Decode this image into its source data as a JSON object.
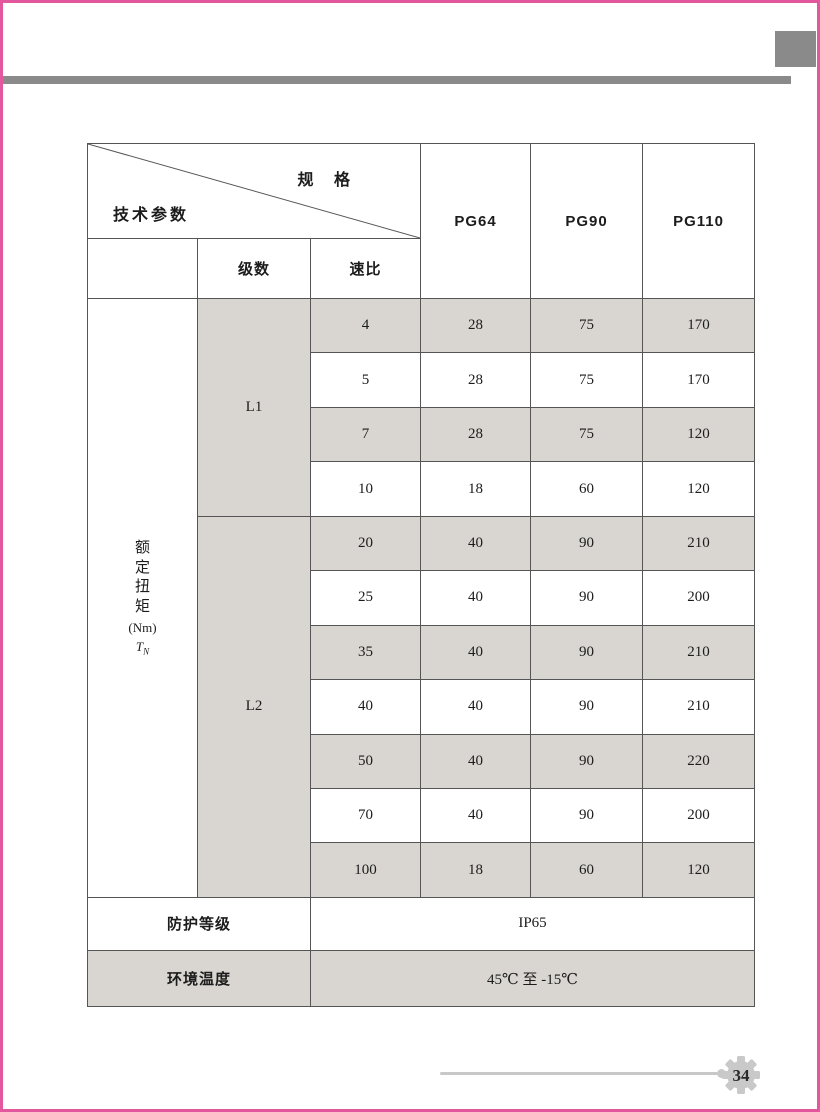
{
  "page": {
    "page_number": "34",
    "accent_pink": "#e2579e",
    "bar_gray": "#8a8a8a",
    "shade_gray": "#d9d6d1"
  },
  "table": {
    "corner": {
      "top_label": "规 格",
      "bottom_label": "技术参数"
    },
    "spec_columns": [
      "PG64",
      "PG90",
      "PG110"
    ],
    "subheaders": {
      "stages": "级数",
      "ratio": "速比"
    },
    "torque": {
      "vertical_label": "额定扭矩",
      "unit": "(Nm)",
      "symbol": "T",
      "symbol_sub": "N"
    },
    "groups": {
      "l1": "L1",
      "l2": "L2"
    },
    "rows": [
      {
        "ratio": "4",
        "pg64": "28",
        "pg90": "75",
        "pg110": "170"
      },
      {
        "ratio": "5",
        "pg64": "28",
        "pg90": "75",
        "pg110": "170"
      },
      {
        "ratio": "7",
        "pg64": "28",
        "pg90": "75",
        "pg110": "120"
      },
      {
        "ratio": "10",
        "pg64": "18",
        "pg90": "60",
        "pg110": "120"
      },
      {
        "ratio": "20",
        "pg64": "40",
        "pg90": "90",
        "pg110": "210"
      },
      {
        "ratio": "25",
        "pg64": "40",
        "pg90": "90",
        "pg110": "200"
      },
      {
        "ratio": "35",
        "pg64": "40",
        "pg90": "90",
        "pg110": "210"
      },
      {
        "ratio": "40",
        "pg64": "40",
        "pg90": "90",
        "pg110": "210"
      },
      {
        "ratio": "50",
        "pg64": "40",
        "pg90": "90",
        "pg110": "220"
      },
      {
        "ratio": "70",
        "pg64": "40",
        "pg90": "90",
        "pg110": "200"
      },
      {
        "ratio": "100",
        "pg64": "18",
        "pg90": "60",
        "pg110": "120"
      }
    ],
    "footer_rows": [
      {
        "label": "防护等级",
        "value": "IP65"
      },
      {
        "label": "环境温度",
        "value": "45℃ 至 -15℃"
      }
    ]
  }
}
